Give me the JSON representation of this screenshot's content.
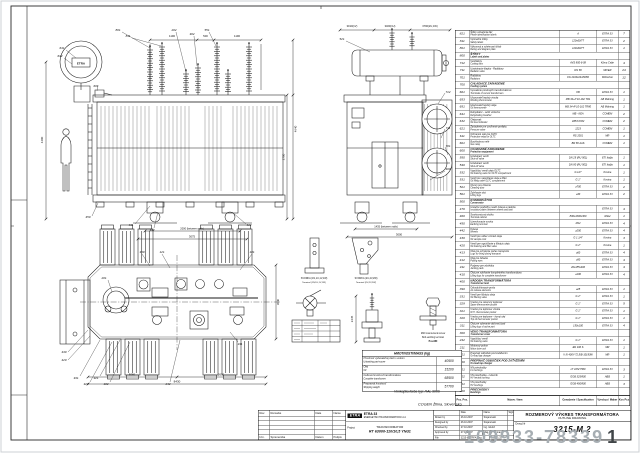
{
  "page": {
    "customer": "COGEN Žilina, Slovensko",
    "paint_note": "Vonkajšia farba typ: RAL 9006"
  },
  "watermark": {
    "id": "109933-78339",
    "suffix": "1"
  },
  "parts_table": {
    "header": {
      "pos": "Poz. Pos.",
      "item": "Názov / Item",
      "spec": "Označenie / Specification",
      "maker": "Výrobca / Maker",
      "qty": "Kos Pcs"
    },
    "rows": [
      {
        "pos": "821",
        "sk": "Štítky označenia fáz",
        "en": "Phase identification labels",
        "spec": "A",
        "maker": "ETRA 33",
        "qty": "7"
      },
      {
        "pos": "811",
        "sk": "Výstražné štítky",
        "en": "Safety labels",
        "spec": "120x60/77",
        "maker": "ETRA 33",
        "qty": "2"
      },
      {
        "pos": "801",
        "sk": "Výkonový a schémový štítok",
        "en": "Rating and diagram plate",
        "spec": "120x60/77",
        "maker": "ETRA 33",
        "qty": "1"
      },
      {
        "pos": "800",
        "section": true,
        "sk": "ŠTÍTKY",
        "en": "Labels and plates"
      },
      {
        "pos": "712",
        "sk": "Ventilátory",
        "en": "Cooling fans",
        "spec": "AVS 800-6-08",
        "maker": "Klima Celje",
        "qty": "4"
      },
      {
        "pos": "711",
        "sk": "Uzatváracie klapky - Radiátory",
        "en": "Radiator valve",
        "spec": "DN 80",
        "maker": "MIVER",
        "qty": "24"
      },
      {
        "pos": "701",
        "sk": "Radiátory",
        "en": "Radiators",
        "spec": "FG 2100x24x80/80",
        "maker": "Wiktscher",
        "qty": "12"
      },
      {
        "pos": "700",
        "section": true,
        "sk": "CHLADIACE ZARIADENIE",
        "en": "Cooling system"
      },
      {
        "pos": "661",
        "sk": "Vyvedenie prúdových transformátorov",
        "en": "Terminals of current transformers",
        "spec": "KB",
        "maker": "ETRA 33",
        "qty": "1"
      },
      {
        "pos": "653",
        "sk": "Ukazovateľ teploty vinutia",
        "en": "Winding thermometer",
        "spec": "MB 34+P 10-162 TR1",
        "maker": "AB Mätning",
        "qty": "1"
      },
      {
        "pos": "651",
        "sk": "Ukazovateľ teploty oleja",
        "en": "Oil thermometer",
        "spec": "MB 34+P 10-162 TR80",
        "maker": "AB Mätning",
        "qty": "1"
      },
      {
        "pos": "641",
        "sk": "Dehydrátor - sušič vzduchu",
        "en": "Dehydrating breather",
        "spec": "MB - KEA",
        "maker": "COMEM",
        "qty": "2"
      },
      {
        "pos": "632",
        "sk": "Olejoznak",
        "en": "Oil level indicator",
        "spec": "LB53 KOM",
        "maker": "COMEM",
        "qty": "2"
      },
      {
        "pos": "621",
        "sk": "Zariadenie pre uvoľnenie pretlaku",
        "en": "Pressure valve",
        "spec": "1223",
        "maker": "COMEM",
        "qty": "1"
      },
      {
        "pos": "611",
        "sk": "Ochranné relé pre OLTC",
        "en": "Protective relay for OLTC",
        "spec": "RS 2001",
        "maker": "MR",
        "qty": "1"
      },
      {
        "pos": "601",
        "sk": "Buchholzovo relé",
        "en": "Gas relay",
        "spec": "BR 80 AAS",
        "maker": "COMEM",
        "qty": "1"
      },
      {
        "pos": "600",
        "section": true,
        "sk": "OCHRANNÉ ZARIADENIE",
        "en": "Protection equipment"
      },
      {
        "pos": "550",
        "sk": "Uzatvárací ventil",
        "en": "Shut-off valve",
        "spec": "DN 25 (RU 501)",
        "maker": "ETI Italija",
        "qty": "1"
      },
      {
        "pos": "540",
        "sk": "Uzatvárací ventil",
        "en": "Shut-off valve",
        "spec": "DN 80 (RU 502)",
        "maker": "ETI Italija",
        "qty": "1"
      },
      {
        "pos": "532",
        "sk": "Vypúšťací ventil oleja OLTC",
        "en": "Oil draining valve for OLTC compartment",
        "spec": "G 1/2\"",
        "maker": "Kovina",
        "qty": "1"
      },
      {
        "pos": "531",
        "sk": "Ventil pre napúšťanie oleja a filter",
        "en": "Oil filling valve OLTC compartment",
        "spec": "G 1\"",
        "maker": "Kovina",
        "qty": "1"
      },
      {
        "pos": "521",
        "sk": "Otvory pre čistenie",
        "en": "Cleaning door",
        "spec": "⌀700",
        "maker": "ETRA 33",
        "qty": "2"
      },
      {
        "pos": "501",
        "sk": "Zdvíhacie oká",
        "en": "Lifting lugs",
        "spec": "⌀30",
        "maker": "ETRA 33",
        "qty": "2"
      },
      {
        "pos": "500",
        "section": true,
        "sk": "KONZERVÁTOR",
        "en": "Conservator"
      },
      {
        "pos": "470",
        "sk": "Izolačné podložky medzi kolesá a nádobu",
        "en": "Insulation plates between wheels and tank",
        "spec": "",
        "maker": "ETRA 33",
        "qty": "4"
      },
      {
        "pos": "460",
        "sk": "Svorkovnicová skriňa",
        "en": "Terminal cabinet",
        "spec": "800x1000x300",
        "maker": "Rittal",
        "qty": "1"
      },
      {
        "pos": "450",
        "sk": "Uzemňovacie svorky",
        "en": "Earthing terminal",
        "spec": "M12",
        "maker": "ETRA 33",
        "qty": "4"
      },
      {
        "pos": "442",
        "sk": "Kolesá",
        "en": "Wheels",
        "spec": "⌀250",
        "maker": "ETRA 33",
        "qty": "4"
      },
      {
        "pos": "430",
        "sk": "Ventil pre odber vzoriek oleja",
        "en": "Oil sample cock",
        "spec": "G 1 1/4\"",
        "maker": "Kovina",
        "qty": "3"
      },
      {
        "pos": "420",
        "sk": "Ventil pre vypúšťanie a filtráciu oleja",
        "en": "Oil draining and filter valve",
        "spec": "G 2\"",
        "maker": "Kovina",
        "qty": "1"
      },
      {
        "pos": "413",
        "sk": "Oká pre uchytenie počas transportu",
        "en": "Lugs for fixing during transport",
        "spec": "⌀60",
        "maker": "ETRA 33",
        "qty": "4"
      },
      {
        "pos": "412",
        "sk": "Oká pre ťahanie",
        "en": "Pulling eyes",
        "spec": "⌀50",
        "maker": "ETRA 33",
        "qty": "4"
      },
      {
        "pos": "411",
        "sk": "Podpery pre zdviháky",
        "en": "Jacking pads",
        "spec": "20x185x400",
        "maker": "ETRA 33",
        "qty": "4"
      },
      {
        "pos": "410",
        "sk": "Oká pre zdvíhanie kompletného transformátora",
        "en": "Lifting lugs for complete transformer",
        "spec": "⌀100",
        "maker": "ETRA 33",
        "qty": "4"
      },
      {
        "pos": "400",
        "section": true,
        "sk": "NÁDOBA TRANSFORMÁTORA",
        "en": "Transformer tank"
      },
      {
        "pos": "390",
        "sk": "Odvzdušňovacie prvky",
        "en": "Air release elements",
        "spec": "⌀25",
        "maker": "ETRA 33",
        "qty": "1"
      },
      {
        "pos": "331",
        "sk": "Ventil pre filtráciu oleja",
        "en": "Oil filtering valve",
        "spec": "G 2\"",
        "maker": "ETRA 33",
        "qty": "1"
      },
      {
        "pos": "329",
        "sk": "Vrecko pre rezervný teplomer",
        "en": "Spare thermometer pocket",
        "spec": "G 1\"",
        "maker": "ETRA 33",
        "qty": "5"
      },
      {
        "pos": "321",
        "sk": "Vrecko pre teplomer vinutia",
        "en": "W.Ti. thermometer pocket",
        "spec": "G 1\"",
        "maker": "ETRA 33",
        "qty": "1"
      },
      {
        "pos": "320",
        "sk": "Vrecko pre teplomer - horný olej",
        "en": "Top oil thermometer pocket",
        "spec": "G 1\"",
        "maker": "ETRA 33",
        "qty": "1"
      },
      {
        "pos": "311",
        "sk": "Oká pre vyberanie aktívnej časti",
        "en": "Lifting lugs of active part",
        "spec": "150x100",
        "maker": "ETRA 33",
        "qty": "4"
      },
      {
        "pos": "300",
        "section": true,
        "sk": "VEKO TRANSFORMÁTORA",
        "en": "Transformer cover"
      },
      {
        "pos": "242",
        "sk": "Vypúšťací ventil",
        "en": "Oil draining valve",
        "spec": "G 1\"",
        "maker": "ETRA 33",
        "qty": "1"
      },
      {
        "pos": "211",
        "sk": "Motorový pohon",
        "en": "Motor drive unit",
        "spec": "ED 100 S",
        "maker": "MR",
        "qty": "1"
      },
      {
        "pos": "201",
        "sk": "Prepínač odbočiek pod zaťažením",
        "en": "On-load tap changer",
        "spec": "V III 400Y-72,5/B-10193W",
        "maker": "MR",
        "qty": "1"
      },
      {
        "pos": "200",
        "section": true,
        "sk": "PREPÍNAČ ODBOČIEK POD ZAŤAŽENÍM",
        "en": "On-load tap changer"
      },
      {
        "pos": "121",
        "sk": "NN priechodky",
        "en": "LV bushings",
        "spec": "LT 10N/Y500",
        "maker": "ETRA 33",
        "qty": "3"
      },
      {
        "pos": "102",
        "sk": "VN priechodka - nulovník",
        "en": "HV neutral bushing",
        "spec": "GOB 325/800",
        "maker": "ABB",
        "qty": "1"
      },
      {
        "pos": "101",
        "sk": "VN priechodky",
        "en": "HV bushings",
        "spec": "GOB 450/800",
        "maker": "ABB",
        "qty": "3"
      },
      {
        "pos": "100",
        "section": true,
        "sk": "PRIECHODKY",
        "en": "Bushings"
      }
    ]
  },
  "weights": {
    "title": "HMOTNOSTI/MASS  (kg)",
    "rows": [
      {
        "sk": "Hmotnosť vyberateľnej časti s vekom",
        "en": "Untanking part+cover",
        "v": "40500"
      },
      {
        "sk": "Olej",
        "en": "Oil",
        "v": "15200"
      },
      {
        "sk": "Celková hmotnosť transformátora",
        "en": "Complete transformer",
        "v": "68500"
      },
      {
        "sk": "Prepravná hmotnosť",
        "en": "Shipping weight",
        "v": "57700"
      }
    ]
  },
  "title_block": {
    "revision": {
      "top": [
        "Rev.",
        "Remarks",
        "Date",
        "Name"
      ],
      "bottom": [
        "Izm.",
        "Sprememba",
        "Datum",
        "Podpis"
      ]
    },
    "company": {
      "logo": "ETRA",
      "name1": "ETRA 33",
      "name2": "ENERGETSKI TRANSFORMATORJI d.d.",
      "project_label": "Project",
      "project1": "TRANSFORMATOR",
      "project2": "RT 63000-110/10,5 YNd1"
    },
    "signatures": {
      "cols": [
        "Date",
        "Name",
        "Sign."
      ],
      "rows": [
        [
          "Drawn by",
          "26.10.2007",
          "Stojanovski"
        ],
        [
          "Designed by",
          "26.10.2007",
          "Stojanovski"
        ],
        [
          "Checked by",
          "27.10.2007",
          "Ing. Glušič"
        ],
        [
          "Approved by",
          "27.10.2007",
          "Mag.Ing. Jerman"
        ]
      ],
      "file_label": "File",
      "file": "3215-M2TRFA.dwg",
      "scale": "Scale 1:25"
    },
    "title": {
      "sk": "ROZMEROVÝ VÝKRES TRANSFORMÁTORA",
      "en": "OUTLINE DRAWING",
      "drwg_label": "Drwg.Nr",
      "drwg_no": "3215-M.2"
    }
  },
  "labels": {
    "dims_front": [
      "1190",
      "500",
      "1190",
      "4640",
      "2700",
      "4400",
      "2000 (between rails)",
      "3075"
    ],
    "dims_side": [
      "3190(1V)",
      "3460(1U)",
      "3790(2U,1W)",
      "1435 (between rails)",
      "3000"
    ],
    "dims_plan": [
      "5060",
      "2670",
      "8430",
      "3040"
    ],
    "dims_detail": [
      "2445"
    ],
    "callouts_front": [
      "801",
      "811",
      "601",
      "641",
      "632",
      "202",
      "302",
      "551",
      "411",
      "442",
      "450",
      "412"
    ],
    "callouts_side": [
      "712",
      "711",
      "701",
      "460",
      "521"
    ],
    "callouts_plan": [
      "331",
      "329",
      "321",
      "102",
      "242",
      "101",
      "121",
      "201",
      "311",
      "390",
      "430",
      "420"
    ],
    "captions": {
      "terminal1": [
        "SVORKA (1N,1U,1V,1W)",
        "Terminal (1N,1U,1V,1W)"
      ],
      "terminal2": [
        "SVORKA (2U,2V,2W)",
        "Terminal (2U,2V,2W)"
      ],
      "earthing": [
        "M20 countersunk screw",
        "Bolt earthing terminal",
        "Pos.680"
      ],
      "conservator_logo": "ETRA"
    }
  }
}
